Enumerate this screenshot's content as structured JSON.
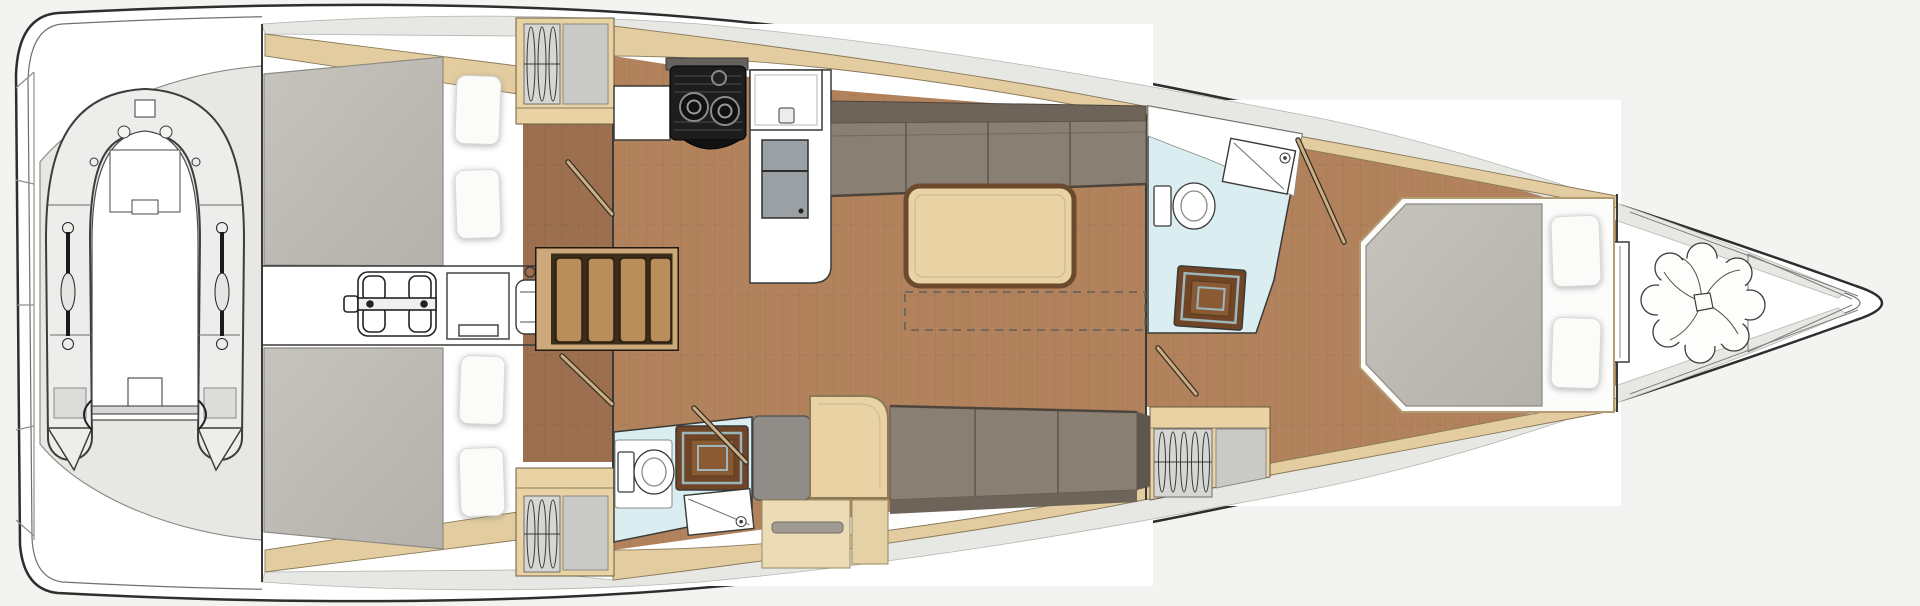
{
  "page": {
    "title": "Sailing yacht interior layout — top view floor plan"
  },
  "diagram": {
    "type": "floorplan",
    "subject": "three-cabin sailing yacht interior, plan view",
    "orientation": {
      "bow": "right",
      "stern": "left"
    },
    "counts": {
      "cabins": 3,
      "heads": 2,
      "berth-pillows": 6,
      "stair-treads": 4,
      "stove-burners": 2,
      "wardrobes": 3
    },
    "areas": [
      {
        "id": "swim-platform",
        "label": "Stern swim platform",
        "items": [
          "transom-steps"
        ]
      },
      {
        "id": "tender-garage",
        "label": "Tender garage",
        "items": [
          "inflatable-dinghy",
          "oars",
          "bow-seat",
          "outboard-transom"
        ]
      },
      {
        "id": "aft-cabin-port",
        "label": "Aft double cabin (top)",
        "items": [
          "double-berth",
          "pillows",
          "wardrobe-with-hangers"
        ]
      },
      {
        "id": "aft-cabin-starboard",
        "label": "Aft double cabin (bottom)",
        "items": [
          "double-berth",
          "pillows",
          "wardrobe-with-hangers"
        ]
      },
      {
        "id": "engine-room",
        "label": "Engine compartment under cockpit",
        "items": [
          "engine",
          "equipment-box",
          "water-heater"
        ]
      },
      {
        "id": "companionway",
        "label": "Companionway steps",
        "items": [
          "four-wood-treads"
        ]
      },
      {
        "id": "galley",
        "label": "Galley",
        "items": [
          "two-burner-stove",
          "sink",
          "refrigerator",
          "counter-peninsula"
        ]
      },
      {
        "id": "salon",
        "label": "Salon / dinette",
        "items": [
          "l-sofa",
          "dining-table",
          "floor-hatch-dashed",
          "settee",
          "chart-seat",
          "chart-table",
          "cabinets"
        ]
      },
      {
        "id": "aft-head",
        "label": "Aft head with shower",
        "items": [
          "toilet",
          "teak-shower-grate",
          "sink"
        ]
      },
      {
        "id": "forward-head",
        "label": "Forward head with shower",
        "items": [
          "toilet",
          "sink-counter",
          "teak-shower-grate"
        ]
      },
      {
        "id": "forward-cabin",
        "label": "Owner's forward cabin",
        "items": [
          "island-berth",
          "pillows",
          "wardrobe-with-hangers"
        ]
      },
      {
        "id": "forepeak",
        "label": "Forepeak anchor locker",
        "items": [
          "anchor-rode-coil",
          "windlass",
          "shelves"
        ]
      }
    ],
    "colors": {
      "bg": "#f3f3f1",
      "hull": "#ffffff",
      "line": "#2e2e2c",
      "deck-gray": "#e7e7e4",
      "band-tan": "#e3cda0",
      "wood-light": "#e9d3a4",
      "floor-mid": "#b2825c",
      "floor-dark": "#9c6f4f",
      "mattress": "#bfbcb6",
      "pillow": "#fbfbfa",
      "sofa": "#8a7f73",
      "sofa-back": "#6e645a",
      "bath-blue": "#daeef1",
      "teak": "#6f4526",
      "teak-light": "#8a5a34",
      "grate-trim": "#9db6bd",
      "stove-dark": "#1d1d1d",
      "fridge-gray": "#9aa0a4",
      "stair-frame": "#cda87a",
      "stair-tread": "#b98e5a",
      "gray-panel": "#c9c9c7",
      "tube": "#ededeb"
    }
  }
}
